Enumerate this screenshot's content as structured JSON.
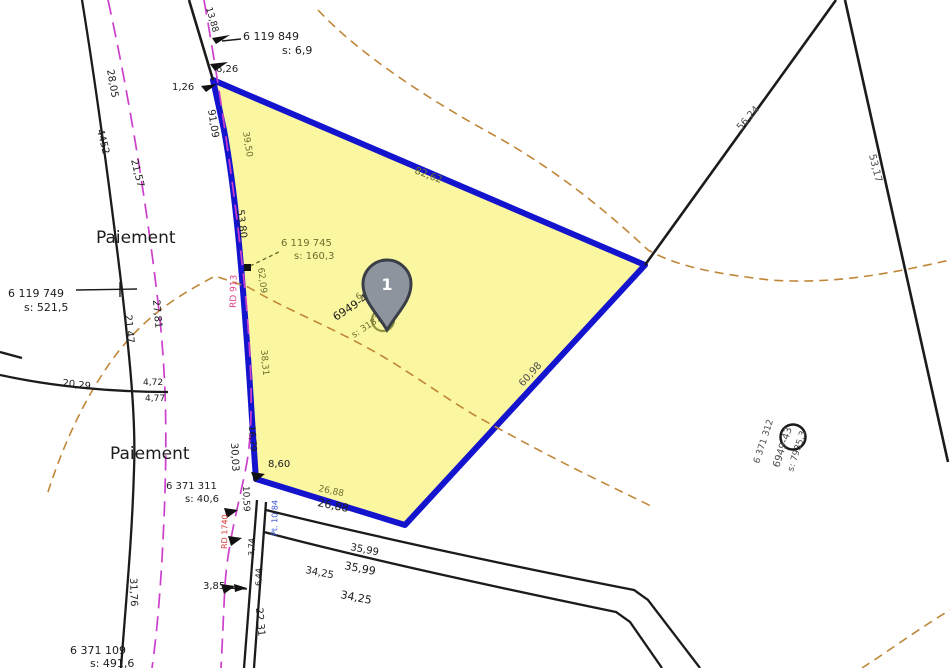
{
  "map": {
    "marker": {
      "label": "1"
    },
    "place_names": [
      "Paiement",
      "Paiement"
    ],
    "roads": [
      "RD 913",
      "RD 1740"
    ]
  },
  "colors": {
    "black": "#1c1c1c",
    "olive": "#6e6e2e",
    "gray": "#4d4d4d",
    "pink": "#e0468c",
    "red": "#d93a3a",
    "blue": "#3a57d0",
    "parcel_fill": "#fbf7a0",
    "parcel_stroke": "#1414ce",
    "road_dash": "#cc3fcc",
    "contour": "#c08637",
    "pin_fill": "#8e949d",
    "pin_stroke": "#3a3f47"
  },
  "labels": [
    {
      "name": "label-paiement-upper",
      "text": "Paiement",
      "x": 96,
      "y": 243,
      "rot": 0,
      "fs": 17,
      "c": "black"
    },
    {
      "name": "label-paiement-lower",
      "text": "Paiement",
      "x": 110,
      "y": 459,
      "rot": 0,
      "fs": 17,
      "c": "black"
    },
    {
      "name": "label-pt-6119749",
      "text": "6 119 749",
      "x": 8,
      "y": 297,
      "rot": 0,
      "fs": 11,
      "c": "black"
    },
    {
      "name": "label-pt-6119749-s",
      "text": "s: 521,5",
      "x": 24,
      "y": 311,
      "rot": 0,
      "fs": 11,
      "c": "black"
    },
    {
      "name": "label-pt-6119849",
      "text": "6 119 849",
      "x": 243,
      "y": 40,
      "rot": 0,
      "fs": 11,
      "c": "black"
    },
    {
      "name": "label-pt-6119849-s",
      "text": "s: 6,9",
      "x": 282,
      "y": 54,
      "rot": 0,
      "fs": 11,
      "c": "black"
    },
    {
      "name": "label-pt-6119745",
      "text": "6 119 745",
      "x": 281,
      "y": 246,
      "rot": 0,
      "fs": 10,
      "c": "olive"
    },
    {
      "name": "label-pt-6119745-s",
      "text": "s: 160,3",
      "x": 294,
      "y": 259,
      "rot": 0,
      "fs": 10,
      "c": "olive"
    },
    {
      "name": "label-pt-6371311",
      "text": "6 371 311",
      "x": 166,
      "y": 489,
      "rot": 0,
      "fs": 10,
      "c": "black"
    },
    {
      "name": "label-pt-6371311-s",
      "text": "s: 40,6",
      "x": 185,
      "y": 502,
      "rot": 0,
      "fs": 10,
      "c": "black"
    },
    {
      "name": "label-pt-6371109",
      "text": "6 371 109",
      "x": 70,
      "y": 654,
      "rot": 0,
      "fs": 11,
      "c": "black"
    },
    {
      "name": "label-pt-6371109-s",
      "text": "s: 491,6",
      "x": 90,
      "y": 667,
      "rot": 0,
      "fs": 11,
      "c": "black"
    },
    {
      "name": "label-parcel1-id",
      "text": "6 119 746",
      "x": 358,
      "y": 300,
      "rot": -33,
      "fs": 8.5,
      "c": "olive"
    },
    {
      "name": "label-parcel1-ref",
      "text": "6949-44-58",
      "x": 336,
      "y": 321,
      "rot": -33,
      "fs": 11,
      "c": "black"
    },
    {
      "name": "label-parcel1-area",
      "text": "s: 3187,5",
      "x": 354,
      "y": 338,
      "rot": -33,
      "fs": 9,
      "c": "olive"
    },
    {
      "name": "label-parcel2-id",
      "text": "6 371 312",
      "x": 759,
      "y": 464,
      "rot": -72,
      "fs": 9,
      "c": "gray"
    },
    {
      "name": "label-parcel2-ref",
      "text": "6949-43",
      "x": 779,
      "y": 468,
      "rot": -72,
      "fs": 10,
      "c": "gray"
    },
    {
      "name": "label-parcel2-area",
      "text": "s: 7935,3",
      "x": 793,
      "y": 472,
      "rot": -72,
      "fs": 9,
      "c": "gray"
    },
    {
      "name": "dist-28-05",
      "text": "28,05",
      "x": 107,
      "y": 70,
      "rot": 80,
      "fs": 10,
      "c": "black"
    },
    {
      "name": "dist-4452",
      "text": "4452",
      "x": 97,
      "y": 130,
      "rot": 76,
      "fs": 10,
      "c": "black"
    },
    {
      "name": "dist-21-57",
      "text": "21,57",
      "x": 131,
      "y": 160,
      "rot": 76,
      "fs": 10,
      "c": "black"
    },
    {
      "name": "dist-91-09",
      "text": "91,09",
      "x": 208,
      "y": 110,
      "rot": 81,
      "fs": 10,
      "c": "black"
    },
    {
      "name": "dist-13-88",
      "text": "13,88",
      "x": 206,
      "y": 8,
      "rot": 74,
      "fs": 9,
      "c": "black"
    },
    {
      "name": "dist-1-26",
      "text": "1,26",
      "x": 172,
      "y": 90,
      "rot": 0,
      "fs": 10,
      "c": "black"
    },
    {
      "name": "dist-6-26",
      "text": "6,26",
      "x": 216,
      "y": 72,
      "rot": 0,
      "fs": 10,
      "c": "black"
    },
    {
      "name": "dist-39-50",
      "text": "39,50",
      "x": 243,
      "y": 132,
      "rot": 81,
      "fs": 9,
      "c": "olive"
    },
    {
      "name": "dist-53-80",
      "text": "53,80",
      "x": 237,
      "y": 210,
      "rot": 83,
      "fs": 10,
      "c": "black"
    },
    {
      "name": "dist-62-09",
      "text": "62,09",
      "x": 258,
      "y": 268,
      "rot": 83,
      "fs": 9,
      "c": "olive"
    },
    {
      "name": "dist-38-31",
      "text": "38,31",
      "x": 261,
      "y": 350,
      "rot": 85,
      "fs": 9,
      "c": "olive"
    },
    {
      "name": "dist-16-79",
      "text": "16,79",
      "x": 249,
      "y": 426,
      "rot": 86,
      "fs": 9,
      "c": "black"
    },
    {
      "name": "dist-30-03",
      "text": "30,03",
      "x": 231,
      "y": 443,
      "rot": 87,
      "fs": 10,
      "c": "black"
    },
    {
      "name": "dist-10-59",
      "text": "10,59",
      "x": 243,
      "y": 486,
      "rot": 88,
      "fs": 9,
      "c": "black"
    },
    {
      "name": "dist-8-60",
      "text": "8,60",
      "x": 268,
      "y": 467,
      "rot": 0,
      "fs": 10,
      "c": "black"
    },
    {
      "name": "dist-26-88-a",
      "text": "26,88",
      "x": 318,
      "y": 491,
      "rot": 12,
      "fs": 9,
      "c": "olive"
    },
    {
      "name": "dist-26-88-b",
      "text": "26,88",
      "x": 317,
      "y": 506,
      "rot": 11,
      "fs": 11,
      "c": "black"
    },
    {
      "name": "dist-35-99-a",
      "text": "35,99",
      "x": 350,
      "y": 550,
      "rot": 11,
      "fs": 10,
      "c": "black"
    },
    {
      "name": "dist-35-99-b",
      "text": "35,99",
      "x": 344,
      "y": 569,
      "rot": 11,
      "fs": 11,
      "c": "black"
    },
    {
      "name": "dist-34-25-a",
      "text": "34,25",
      "x": 305,
      "y": 573,
      "rot": 11,
      "fs": 10,
      "c": "black"
    },
    {
      "name": "dist-34-25-b",
      "text": "34,25",
      "x": 340,
      "y": 598,
      "rot": 11,
      "fs": 11,
      "c": "black"
    },
    {
      "name": "dist-20-29",
      "text": "20,29",
      "x": 62,
      "y": 386,
      "rot": 7,
      "fs": 10,
      "c": "black"
    },
    {
      "name": "dist-4-72",
      "text": "4,72",
      "x": 143,
      "y": 385,
      "rot": 0,
      "fs": 9,
      "c": "black"
    },
    {
      "name": "dist-4-77",
      "text": "4,77",
      "x": 145,
      "y": 401,
      "rot": 0,
      "fs": 9,
      "c": "black"
    },
    {
      "name": "dist-21-47",
      "text": "21,47",
      "x": 125,
      "y": 315,
      "rot": 85,
      "fs": 10,
      "c": "black"
    },
    {
      "name": "dist-27-81",
      "text": "27,81",
      "x": 153,
      "y": 300,
      "rot": 85,
      "fs": 10,
      "c": "black"
    },
    {
      "name": "dist-31-76",
      "text": "31,76",
      "x": 130,
      "y": 578,
      "rot": 88,
      "fs": 10,
      "c": "black"
    },
    {
      "name": "dist-22-31",
      "text": "22,31",
      "x": 256,
      "y": 608,
      "rot": 85,
      "fs": 10,
      "c": "black"
    },
    {
      "name": "dist-3-85",
      "text": "3,85",
      "x": 203,
      "y": 589,
      "rot": 0,
      "fs": 10,
      "c": "black"
    },
    {
      "name": "dist-82-62",
      "text": "82,62",
      "x": 414,
      "y": 173,
      "rot": 21,
      "fs": 10,
      "c": "olive"
    },
    {
      "name": "dist-60-98",
      "text": "60,98",
      "x": 523,
      "y": 387,
      "rot": -48,
      "fs": 10,
      "c": "gray"
    },
    {
      "name": "dist-56-24",
      "text": "56,24",
      "x": 741,
      "y": 131,
      "rot": -49,
      "fs": 10,
      "c": "gray"
    },
    {
      "name": "dist-53-17",
      "text": "53,17",
      "x": 869,
      "y": 155,
      "rot": 76,
      "fs": 10,
      "c": "gray"
    },
    {
      "name": "road-rd913",
      "text": "RD 913",
      "x": 236,
      "y": 308,
      "rot": -89,
      "fs": 9,
      "c": "pink"
    },
    {
      "name": "road-rd1740",
      "text": "RD 1740",
      "x": 227,
      "y": 549,
      "rot": -89,
      "fs": 8,
      "c": "red"
    },
    {
      "name": "note-pt-10-84",
      "text": "Pt. 10 84",
      "x": 277,
      "y": 536,
      "rot": -89,
      "fs": 8,
      "c": "blue"
    },
    {
      "name": "note-3-74",
      "text": "3,74",
      "x": 254,
      "y": 556,
      "rot": -89,
      "fs": 8,
      "c": "black"
    },
    {
      "name": "note-6-44",
      "text": "6,44",
      "x": 261,
      "y": 586,
      "rot": -89,
      "fs": 8,
      "c": "black"
    }
  ]
}
